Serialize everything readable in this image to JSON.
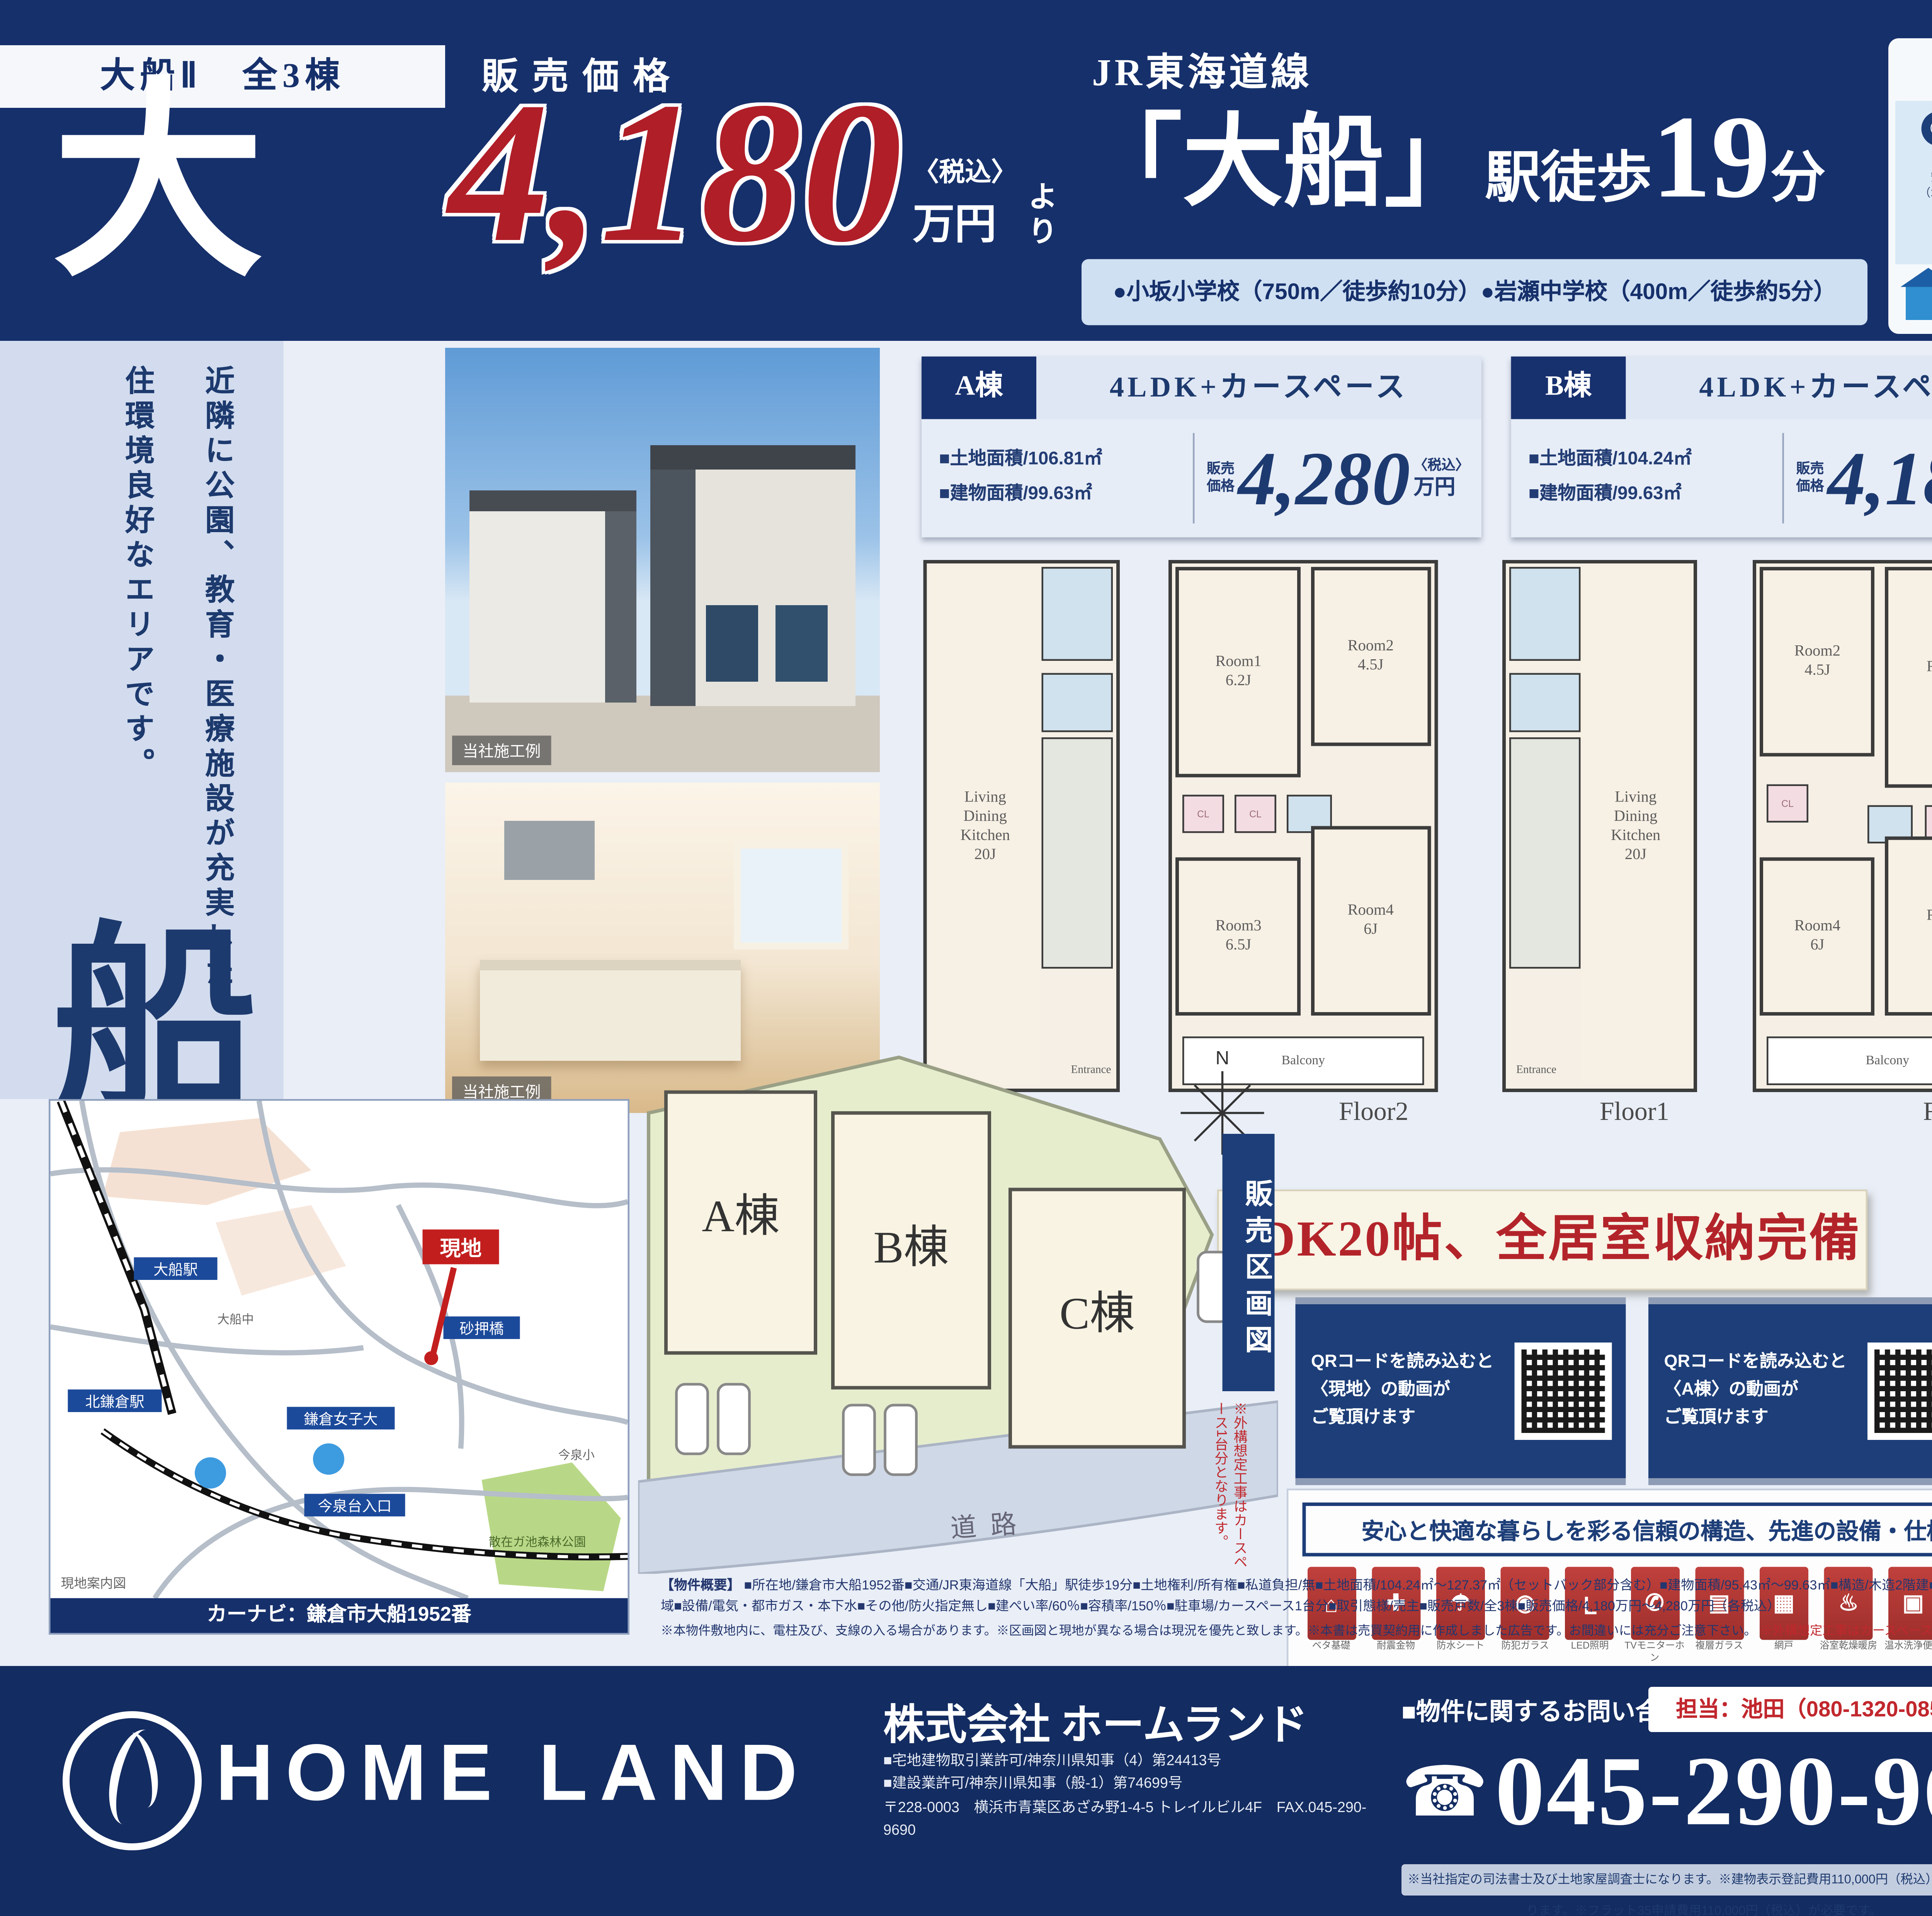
{
  "header": {
    "badge": "大船Ⅱ　全3棟",
    "big_char_top": "大",
    "big_char_side": "船",
    "price_label": "販売価格",
    "price_value": "4,180",
    "price_tax": "〈税込〉",
    "price_unit": "万円",
    "price_yori": "より",
    "line_name": "JR東海道線",
    "station": "「大船」",
    "walk_prefix": "駅徒歩",
    "walk_min": "19",
    "walk_unit": "分",
    "schools": "●小坂小学校（750m／徒歩約10分）●岩瀬中学校（400m／徒歩約5分）"
  },
  "side": {
    "catch1": "近隣に公園、教育・医療施設が充実した",
    "catch2": "住環境良好なエリアです。"
  },
  "ahs": {
    "title": "AHSグループの安心・充実のアフターサービス",
    "services": [
      {
        "icon": "✆",
        "t": "365日24時間10年間\nのコールサービス",
        "desc": "緊急時対応もOK!!\n安心保証サービスのコールセンター\n（水廻り・ガラス・カギ等の駆けつけ）"
      },
      {
        "icon": "✚",
        "t": "お引渡し後2年は\nメンテナンスフリー",
        "desc": "第三者機関と提携し保証期間内は\n無料のメンテナンスサービス\n（消耗品およびお客様過失は除きます）"
      },
      {
        "icon": "◉",
        "t": "お引渡し後も安心の\n定期点検の実施",
        "desc": "お引渡し後、1年目・2年目の定期点検を\n無償で実施します。"
      }
    ],
    "extra_badge": "さらに",
    "extra": "建築中にも第三者検査機関による\n徹底した品質検査を実施しているので安心です!!"
  },
  "photos": {
    "caption1": "当社施工例",
    "caption2": "当社施工例"
  },
  "buildings": [
    {
      "name": "A棟",
      "plan": "4LDK+カースペース",
      "land": "■土地面積/106.81㎡",
      "area": "■建物面積/99.63㎡",
      "sale": "販売\n価格",
      "price": "4,280",
      "tax": "〈税込〉",
      "unit": "万円"
    },
    {
      "name": "B棟",
      "plan": "4LDK+カースペース",
      "land": "■土地面積/104.24㎡",
      "area": "■建物面積/99.63㎡",
      "sale": "販売\n価格",
      "price": "4,180",
      "tax": "〈税込〉",
      "unit": "万円"
    },
    {
      "name": "C棟",
      "plan": "4LDK+カースペース",
      "land": "■土地面積/127.37㎡",
      "area": "■建物面積/95.43㎡",
      "sale": "販売\n価格",
      "price": "4,180",
      "tax": "〈税込〉",
      "unit": "万円"
    }
  ],
  "floorplans": [
    {
      "label": "Floor1",
      "main": "Living\nDining\nKitchen\n20J",
      "ent": "Entrance"
    },
    {
      "label": "Floor2",
      "r_tl": "Room1\n6.2J",
      "r_tr": "Room2\n4.5J",
      "r_bl": "Room3\n6.5J",
      "r_br": "Room4\n6J",
      "balcony": "Balcony"
    },
    {
      "label": "Floor1",
      "main": "Living\nDining\nKitchen\n20J",
      "ent": "Entrance"
    },
    {
      "label": "Floor2",
      "r_tl": "Room2\n4.5J",
      "r_tr": "Room1\n6.5J",
      "r_bl": "Room4\n6J",
      "r_br": "Room3\n6.5J",
      "balcony": "Balcony"
    },
    {
      "label": "Floor1",
      "main": "Living Dining\nKitchen\n17J",
      "ent": "Entrance"
    },
    {
      "label": "Floor2",
      "r_tl": "Room1\n4.5J",
      "r_tr": "Room2\n4.8J",
      "r_bl": "Room3\n6.5J",
      "r_br": "Room4\n6J",
      "wic": "W.I.C",
      "balcony": "Balcony"
    }
  ],
  "banners": {
    "ldk": "LDK20帖、全居室収納完備",
    "wic1": "ウォークインクローゼット",
    "wic2": "リビング・廊下収納付"
  },
  "qr_cards": [
    {
      "l1": "QRコードを読み込むと",
      "l2": "〈現地〉の動画が",
      "l3": "ご覧頂けます"
    },
    {
      "l1": "QRコードを読み込むと",
      "l2": "〈A棟〉の動画が",
      "l3": "ご覧頂けます"
    },
    {
      "l1": "QRコードを読み込むと",
      "l2": "〈B棟〉の動画が",
      "l3": "ご覧頂けます"
    },
    {
      "l1": "QRコードを読み込むと",
      "l2": "〈C棟〉の動画が",
      "l3": "ご覧頂けます"
    }
  ],
  "equipment": {
    "title": "安心と快適な暮らしを彩る信頼の構造、先進の設備・仕様",
    "items": [
      {
        "g": "⌂",
        "c": "ベタ基礎"
      },
      {
        "g": "✚",
        "c": "耐震金物"
      },
      {
        "g": "☂",
        "c": "防水シート"
      },
      {
        "g": "◉",
        "c": "防犯ガラス"
      },
      {
        "g": "Ｌ",
        "c": "LED照明"
      },
      {
        "g": "✆",
        "c": "TVモニターホン"
      },
      {
        "g": "▤",
        "c": "複層ガラス"
      },
      {
        "g": "▦",
        "c": "網戸"
      },
      {
        "g": "♨",
        "c": "浴室乾燥暖房"
      },
      {
        "g": "▣",
        "c": "温水洗浄便座"
      },
      {
        "g": "↻",
        "c": "追焚機能"
      },
      {
        "g": "▥",
        "c": "システムキッチン"
      },
      {
        "g": "◈",
        "c": "浄水器"
      },
      {
        "g": "24H",
        "c": "24時間換気"
      },
      {
        "g": "✦",
        "c": "食器洗浄乾燥機"
      },
      {
        "g": "▢",
        "c": "床下収納"
      },
      {
        "g": "☰",
        "c": "室内物干"
      },
      {
        "g": "◧",
        "c": "洗面化粧台"
      },
      {
        "g": "✇",
        "c": "サーモ水栓"
      },
      {
        "g": "▨",
        "c": "シャッター雨戸"
      },
      {
        "g": "✱",
        "c": "宅配ボックス"
      },
      {
        "g": "◆",
        "c": "オートバス"
      }
    ]
  },
  "aquos": {
    "brand": "AQUOS",
    "sub": "ポータブル",
    "maker": "SHARP",
    "oval_left": "お風呂でも\nリビングでも",
    "f1": "お風呂でゆったり\n持ち運びラクラク",
    "f2": "防水＆静音設計\n安心の防水仕様",
    "f3": "どこへ持ち出しても\nクリアな画質",
    "chips": [
      "16V型",
      "防水・液晶",
      "2番組同時録画対応",
      "無線バッテリー内蔵"
    ],
    "oval_right": "お手頃！軽くて\n持ち運びやすい!"
  },
  "siteplan": {
    "label": "販売区画図",
    "a": "A棟",
    "b": "B棟",
    "c": "C棟",
    "road": "道路",
    "compass": "N",
    "note": "※外構想定工事はカースペース1台分となります。"
  },
  "map": {
    "genchi": "現地",
    "navi": "カーナビ：鎌倉市大船1952番",
    "corner": "現地案内図",
    "labels": [
      "大船駅",
      "北鎌倉駅",
      "鎌倉女子大",
      "砂押橋",
      "今泉台入口"
    ],
    "small_labels": [
      "今泉小",
      "大船中"
    ],
    "park": "散在ガ池森林公園"
  },
  "outline": {
    "title": "【物件概要】",
    "body": "■所在地/鎌倉市大船1952番■交通/JR東海道線「大船」駅徒歩19分■土地権利/所有権■私道負担/無■土地面積/104.24㎡～127.37㎡（セットバック部分含む）■建物面積/95.43㎡～99.63㎡■構造/木造2階建■水道/公営水道■間取/各4LDK■完成予定月/2020年11月上旬完成予定■引渡/2020年12月中旬予定■用途地域/第1種中高層住居専用地域■設備/電気・都市ガス・本下水■その他/防火指定無し■建ぺい率/60％■容積率/150％■駐車場/カースペース1台分■取引態様/売主■販売戸数/全3棟■販売価格/4,180万円～4,280万円（各税込）",
    "notes": "※本物件敷地内に、電柱及び、支線の入る場合があります。※区画図と現地が異なる場合は現況を優先と致します。※本書は売買契約用に作成しました広告です。お間違いには充分ご注意下さい。",
    "note_red": "※外構想定工事はカースペース1台分となります。"
  },
  "footer": {
    "company_en": "HOME LAND",
    "company_jp": "株式会社 ホームランド",
    "license1": "■宅地建物取引業許可/神奈川県知事（4）第24413号",
    "license2": "■建設業許可/神奈川県知事（般-1）第74699号",
    "address": "〒228-0003　横浜市青葉区あざみ野1-4-5 トレイルビル4F　FAX.045-290-9690",
    "contact_label": "■物件に関するお問い合わせ■",
    "tanto": "担当：池田（080-1320-0851）",
    "phone_icon": "☎",
    "phone": "045-290-9670",
    "note": "※当社指定の司法書士及び土地家屋調査士になります。※建物表示登記費用110,000円（税込）が必要になります。※フラット35申請費用110,000円（税込）が必要です。",
    "ad_box1": "広告掲載は",
    "ad_box2": "一切不可とします",
    "bullets": [
      "●取引態様/売主",
      "●手数料/3%（税込）",
      "●情報公開日/2020年"
    ]
  }
}
